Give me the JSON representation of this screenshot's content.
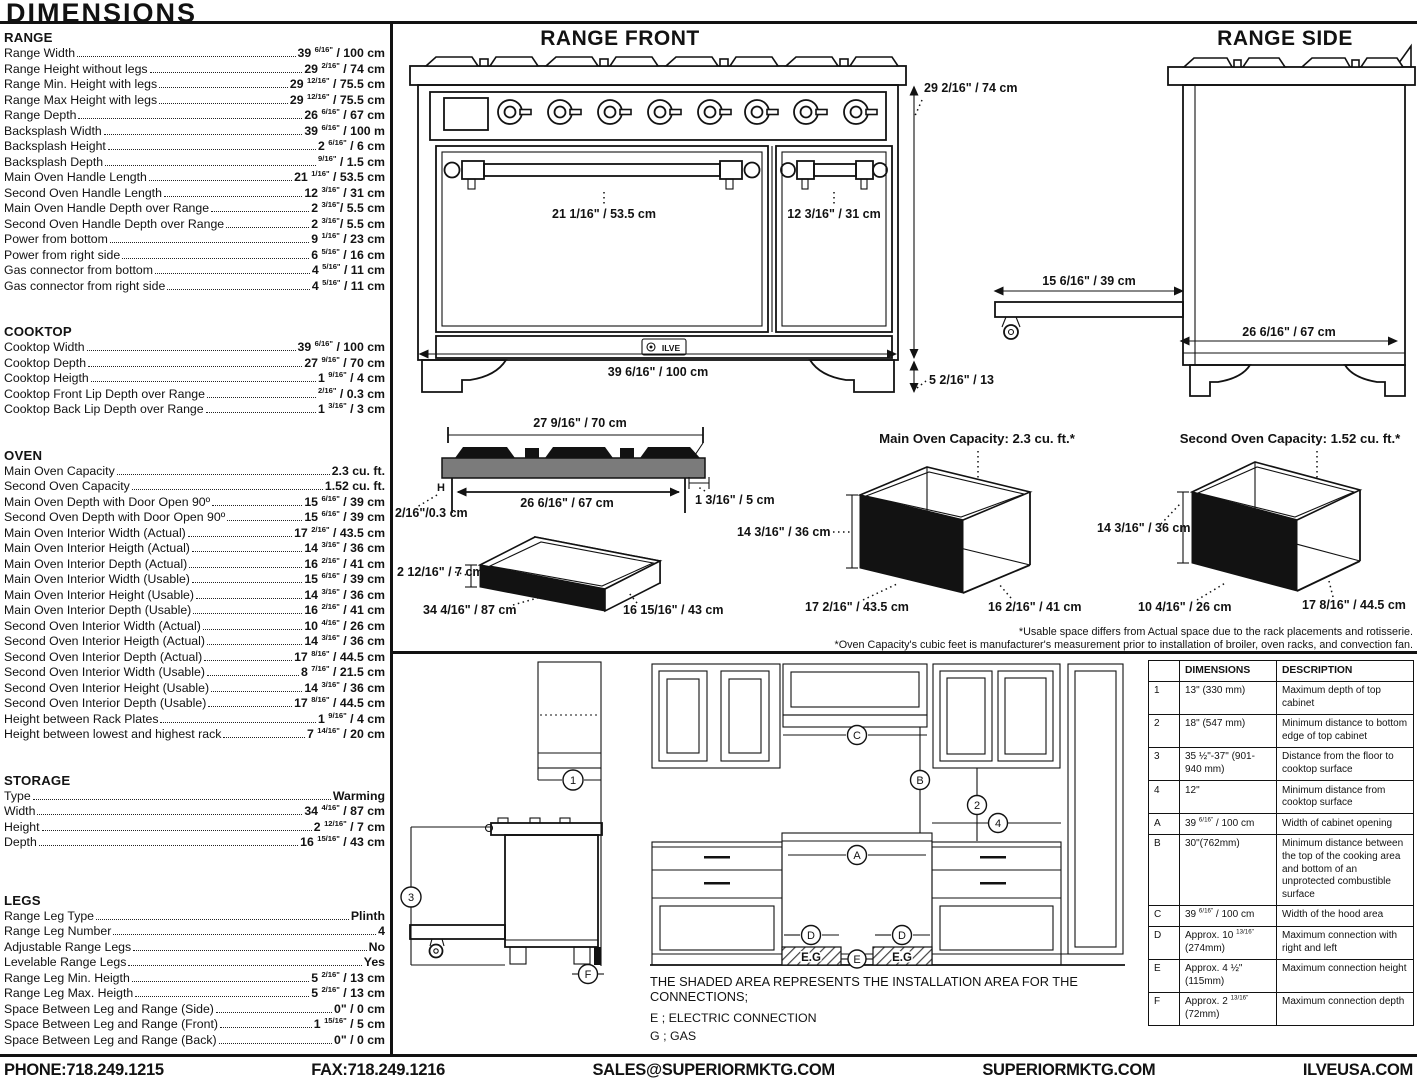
{
  "page": {
    "title": "DIMENSIONS"
  },
  "specs": {
    "sections": [
      {
        "heading": "RANGE",
        "rows": [
          {
            "label": "Range Width",
            "value": "39 6/16\" / 100 cm"
          },
          {
            "label": "Range Height without legs",
            "value": "29 2/16\" / 74 cm"
          },
          {
            "label": "Range Min. Height with legs",
            "value": "29 12/16\" / 75.5 cm"
          },
          {
            "label": "Range Max Height with legs",
            "value": "29 12/16\" / 75.5 cm"
          },
          {
            "label": "Range Depth",
            "value": "26 6/16\" / 67 cm"
          },
          {
            "label": "Backsplash Width",
            "value": "39 6/16\" / 100 m"
          },
          {
            "label": "Backsplash Height",
            "value": "2 6/16\" / 6 cm"
          },
          {
            "label": "Backsplash Depth",
            "value": "9/16\" / 1.5 cm"
          },
          {
            "label": "Main Oven Handle Length",
            "value": "21 1/16\" / 53.5 cm"
          },
          {
            "label": "Second Oven Handle Length",
            "value": "12 3/16\" / 31 cm"
          },
          {
            "label": "Main Oven Handle Depth over Range",
            "value": "2 3/16\"/ 5.5 cm"
          },
          {
            "label": "Second Oven Handle Depth over Range",
            "value": "2 3/16\"/ 5.5 cm"
          },
          {
            "label": "Power from bottom",
            "value": "9 1/16\" / 23 cm"
          },
          {
            "label": "Power from right side",
            "value": "6 5/16\" / 16 cm"
          },
          {
            "label": "Gas connector from bottom",
            "value": "4 5/16\" / 11 cm"
          },
          {
            "label": "Gas connector from right side",
            "value": "4 5/16\" / 11 cm"
          }
        ]
      },
      {
        "heading": "COOKTOP",
        "rows": [
          {
            "label": "Cooktop Width",
            "value": "39 6/16\" / 100 cm"
          },
          {
            "label": "Cooktop Depth",
            "value": "27 9/16\" / 70 cm"
          },
          {
            "label": "Cooktop Heigth",
            "value": "1 9/16\" / 4 cm"
          },
          {
            "label": "Cooktop Front Lip Depth over Range",
            "value": "2/16\" / 0.3 cm"
          },
          {
            "label": "Cooktop Back Lip Depth over Range",
            "value": "1 3/16\" / 3 cm"
          }
        ]
      },
      {
        "heading": "OVEN",
        "rows": [
          {
            "label": "Main Oven Capacity",
            "value": "2.3 cu. ft."
          },
          {
            "label": "Second Oven Capacity",
            "value": "1.52 cu. ft."
          },
          {
            "label": "Main Oven Depth with Door Open 90º",
            "value": "15 6/16\" / 39 cm"
          },
          {
            "label": "Second Oven Depth with Door Open 90º",
            "value": "15 6/16\" / 39 cm"
          },
          {
            "label": "Main Oven Interior Width (Actual)",
            "value": "17 2/16\" / 43.5 cm"
          },
          {
            "label": "Main Oven Interior Heigth (Actual)",
            "value": "14 3/16\" / 36 cm"
          },
          {
            "label": "Main Oven Interior Depth (Actual)",
            "value": "16 2/16\" / 41 cm"
          },
          {
            "label": "Main Oven Interior Width (Usable)",
            "value": "15 6/16\" / 39 cm"
          },
          {
            "label": "Main Oven Interior Height (Usable)",
            "value": "14 3/16\" / 36 cm"
          },
          {
            "label": "Main Oven Interior Depth (Usable)",
            "value": "16 2/16\" / 41 cm"
          },
          {
            "label": "Second Oven Interior Width (Actual)",
            "value": "10 4/16\" / 26 cm"
          },
          {
            "label": "Second Oven Interior Heigth (Actual)",
            "value": "14 3/16\" / 36 cm"
          },
          {
            "label": "Second Oven Interior Depth (Actual)",
            "value": "17 8/16\" / 44.5 cm"
          },
          {
            "label": "Second Oven Interior Width (Usable)",
            "value": "8 7/16\" / 21.5 cm"
          },
          {
            "label": "Second Oven Interior Height (Usable)",
            "value": "14 3/16\" / 36 cm"
          },
          {
            "label": "Second Oven Interior Depth (Usable)",
            "value": "17 8/16\" / 44.5 cm"
          },
          {
            "label": "Height between Rack Plates",
            "value": "1 9/16\" / 4 cm"
          },
          {
            "label": "Height between lowest and highest rack",
            "value": "7 14/16\" / 20 cm"
          }
        ]
      },
      {
        "heading": "STORAGE",
        "rows": [
          {
            "label": "Type",
            "value": "Warming"
          },
          {
            "label": "Width",
            "value": "34 4/16\" / 87 cm"
          },
          {
            "label": "Height",
            "value": "2 12/16\" / 7 cm"
          },
          {
            "label": "Depth",
            "value": "16 15/16\" / 43 cm"
          }
        ]
      },
      {
        "heading": "LEGS",
        "rows": [
          {
            "label": "Range Leg Type",
            "value": "Plinth"
          },
          {
            "label": "Range Leg Number",
            "value": "4"
          },
          {
            "label": "Adjustable Range Legs",
            "value": "No"
          },
          {
            "label": "Levelable Range Legs",
            "value": "Yes"
          },
          {
            "label": "Range Leg Min. Heigth",
            "value": "5 2/16\" / 13 cm"
          },
          {
            "label": "Range Leg Max. Heigth",
            "value": "5 2/16\" / 13 cm"
          },
          {
            "label": "Space Between Leg and Range (Side)",
            "value": "0\" / 0 cm"
          },
          {
            "label": "Space Between Leg and Range (Front)",
            "value": "1 15/16\" / 5 cm"
          },
          {
            "label": "Space Between Leg and Range (Back)",
            "value": "0\" / 0 cm"
          }
        ]
      }
    ]
  },
  "diagrams": {
    "range_front": {
      "title": "RANGE FRONT",
      "height": "29 2/16\" / 74 cm",
      "width": "39 6/16\" / 100 cm",
      "leg_height": "5 2/16\" / 13",
      "main_handle": "21 1/16\" / 53.5 cm",
      "second_handle": "12 3/16\" / 31 cm",
      "logo": "ILVE"
    },
    "range_side": {
      "title": "RANGE SIDE",
      "door_open": "15 6/16\" / 39 cm",
      "depth": "26 6/16\" / 67 cm"
    },
    "cooktop_profile": {
      "width_total": "27 9/16\" / 70 cm",
      "width_inner": "26 6/16\" / 67 cm",
      "front_lip": "2/16\"/0.3 cm",
      "back_lip": "1 3/16\" / 5 cm",
      "h_marker": "H"
    },
    "storage_drawer": {
      "height": "2 12/16\" / 7 cm",
      "width": "34 4/16\" / 87 cm",
      "depth": "16 15/16\" / 43 cm"
    },
    "main_oven": {
      "title": "Main Oven Capacity: 2.3 cu. ft.*",
      "height": "14 3/16\" / 36 cm",
      "width": "17 2/16\" / 43.5 cm",
      "depth": "16 2/16\" / 41 cm"
    },
    "second_oven": {
      "title": "Second Oven Capacity: 1.52 cu. ft.*",
      "height": "14 3/16\" / 36 cm",
      "width": "10 4/16\" / 26 cm",
      "depth": "17 8/16\" / 44.5 cm"
    },
    "footnotes": [
      "*Usable space differs from Actual space due to the rack placements and rotisserie.",
      "*Oven Capacity's cubic feet is manufacturer's measurement prior to installation of broiler, oven racks, and convection fan."
    ]
  },
  "installation": {
    "markers": {
      "m1": "1",
      "m2": "2",
      "m3": "3",
      "m4": "4",
      "mA": "A",
      "mB": "B",
      "mC": "C",
      "mD": "D",
      "mE": "E",
      "mF": "F",
      "shaded": "E.G"
    },
    "notes": [
      "THE SHADED AREA REPRESENTS THE INSTALLATION AREA FOR THE CONNECTIONS;",
      "E ; ELECTRIC CONNECTION",
      "G ; GAS"
    ],
    "table": {
      "headers": [
        "DIMENSIONS",
        "DESCRIPTION"
      ],
      "rows": [
        {
          "key": "1",
          "dim": "13\" (330 mm)",
          "desc": "Maximum depth of top cabinet"
        },
        {
          "key": "2",
          "dim": "18\" (547 mm)",
          "desc": "Minimum distance to bottom edge of top cabinet"
        },
        {
          "key": "3",
          "dim": "35 ½\"-37\" (901-940 mm)",
          "desc": "Distance from the floor to cooktop surface"
        },
        {
          "key": "4",
          "dim": "12\"",
          "desc": "Minimum distance from cooktop surface"
        },
        {
          "key": "A",
          "dim": "39 6/16\" / 100 cm",
          "desc": "Width of cabinet opening"
        },
        {
          "key": "B",
          "dim": "30\"(762mm)",
          "desc": "Minimum distance between the top of the cooking area and bottom of an unprotected combustible surface"
        },
        {
          "key": "C",
          "dim": "39 6/16\" / 100 cm",
          "desc": "Width of the hood area"
        },
        {
          "key": "D",
          "dim": "Approx. 10 13/16\" (274mm)",
          "desc": "Maximum connection with right and left"
        },
        {
          "key": "E",
          "dim": "Approx. 4 ½\" (115mm)",
          "desc": "Maximum connection height"
        },
        {
          "key": "F",
          "dim": "Approx. 2 13/16\" (72mm)",
          "desc": "Maximum connection depth"
        }
      ]
    }
  },
  "footer": {
    "phone": "PHONE:718.249.1215",
    "fax": "FAX:718.249.1216",
    "email": "SALES@SUPERIORMKTG.COM",
    "website": "SUPERIORMKTG.COM",
    "website2": "ILVEUSA.COM"
  }
}
